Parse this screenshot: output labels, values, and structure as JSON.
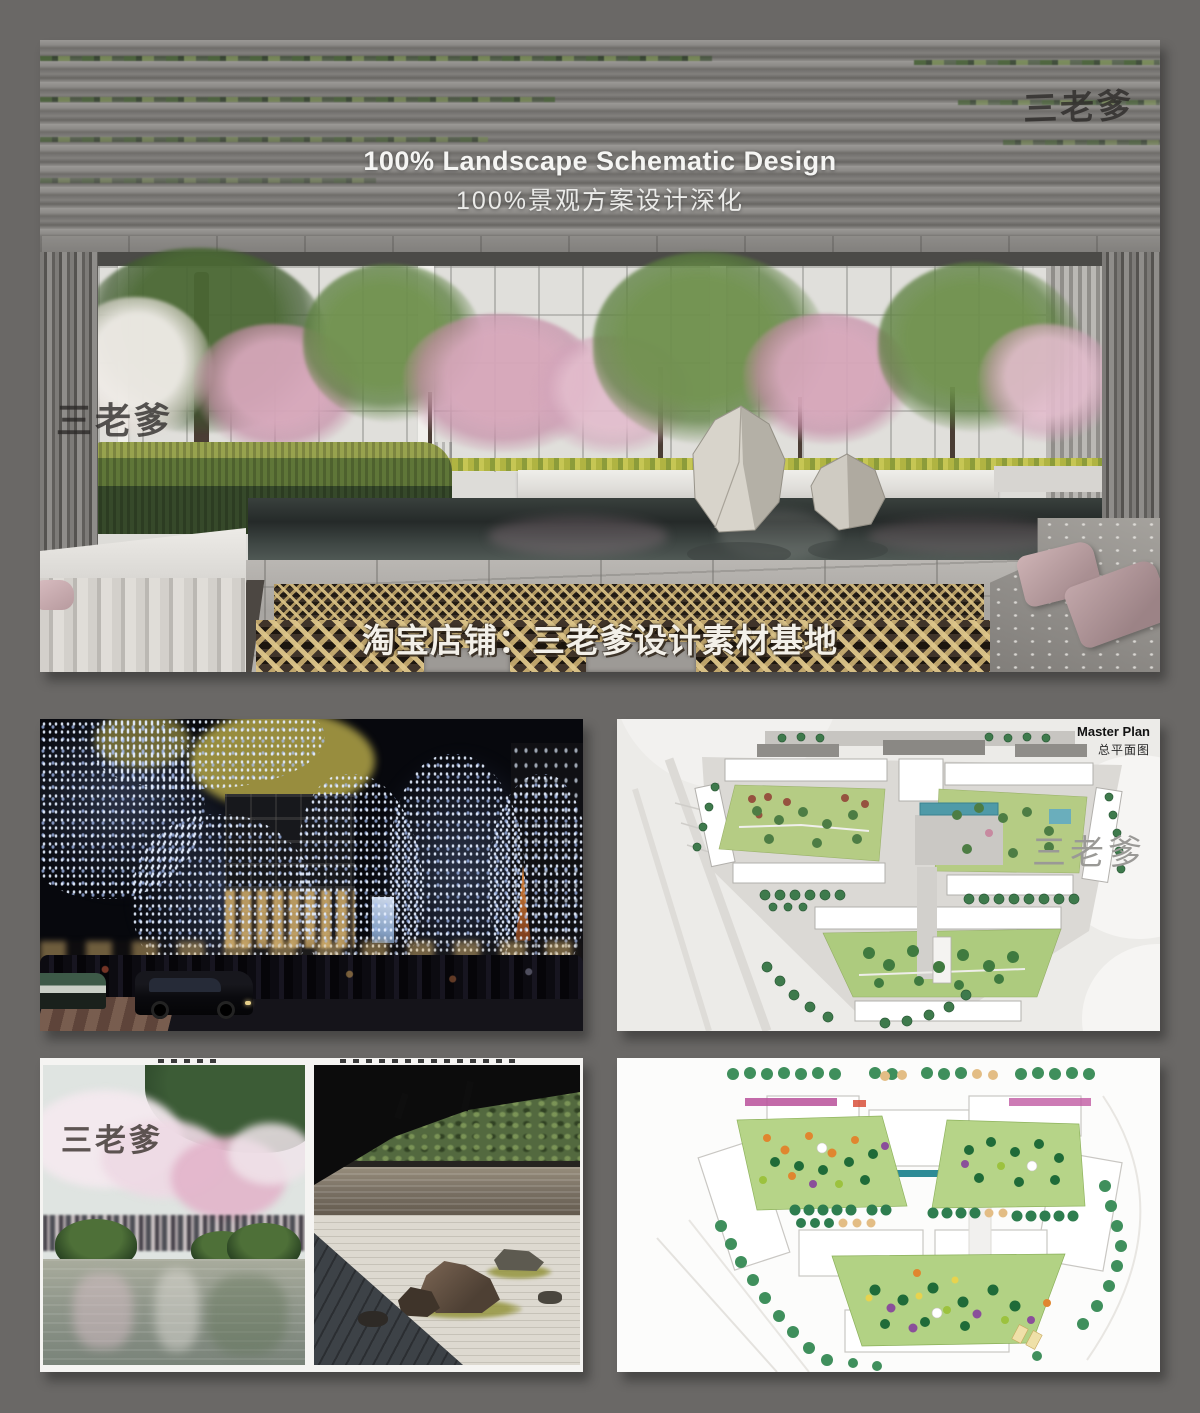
{
  "hero": {
    "title_en": "100% Landscape Schematic Design",
    "title_zh": "100%景观方案设计深化",
    "watermark_top_right": "三老爹",
    "watermark_left": "三老爹",
    "watermark_bottom": "淘宝店铺：三老爹设计素材基地"
  },
  "master_plan": {
    "title_en": "Master Plan",
    "title_zh": "总平面图",
    "watermark": "三老爹"
  },
  "garden_photos": {
    "watermark": "三老爹"
  },
  "colors": {
    "page_background": "#6a6866",
    "slat_gray": "#85837f",
    "blossom_pink": "#d4a4ba",
    "pool_dark": "#2e3332",
    "gold_paving": "#c9ae74",
    "night_lights": "#cfdcff",
    "plan_courtyard_green": "#b5cc84",
    "plan_tree_green": "#3e7a4c",
    "plan_pool_teal": "#58a0ae",
    "cushion_pink": "#bda4a6"
  }
}
